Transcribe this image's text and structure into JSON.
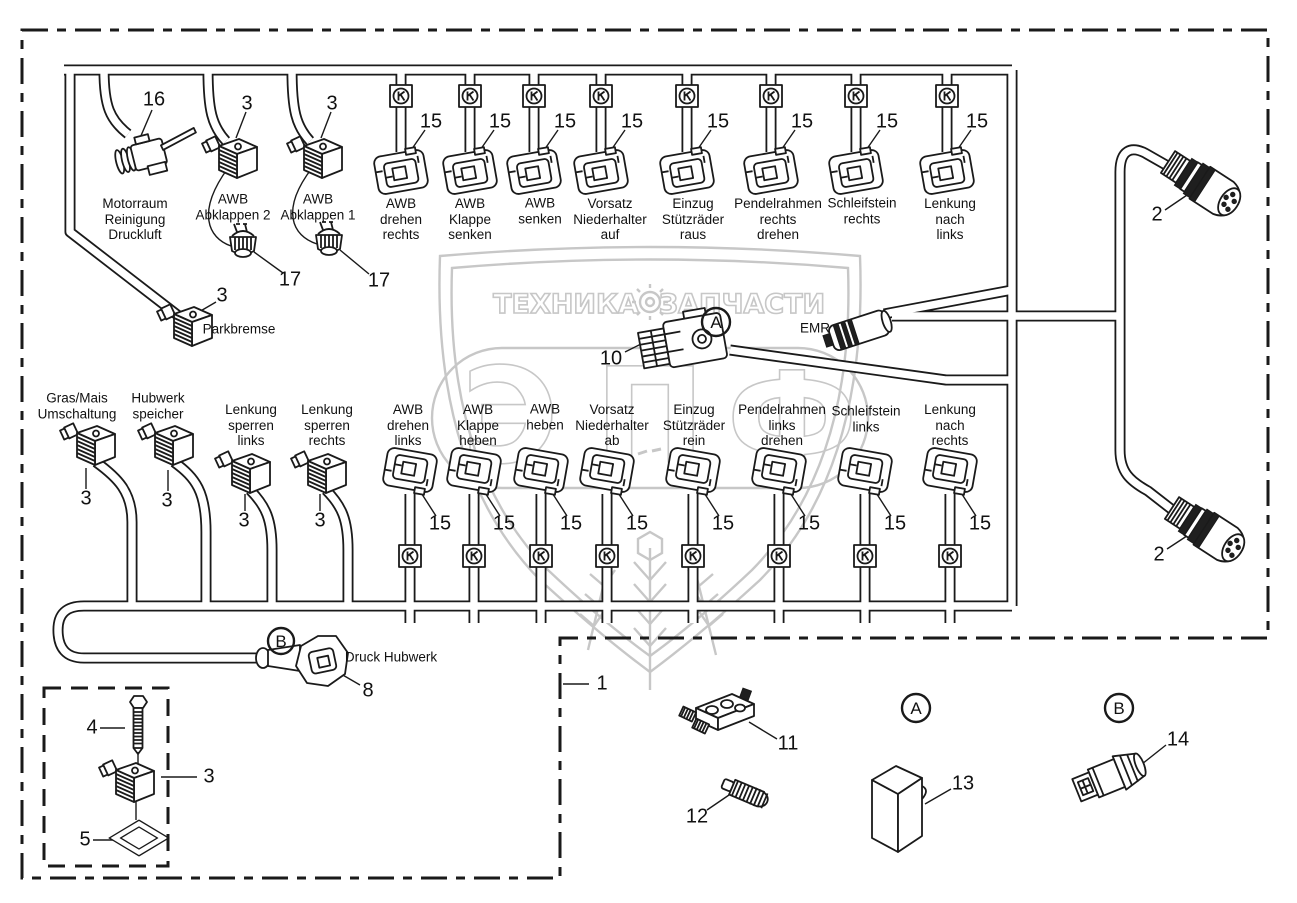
{
  "diagram": {
    "callouts": {
      "a": "A",
      "b": "B"
    },
    "rows": {
      "top": [
        {
          "label": "Motorraum\nReinigung\nDruckluft",
          "num": "16"
        },
        {
          "label": "AWB\nAbklappen 2",
          "num": "3",
          "plug_num": "17"
        },
        {
          "label": "AWB\nAbklappen 1",
          "num": "3",
          "plug_num": "17"
        },
        {
          "label": "AWB\ndrehen\nrechts",
          "num": "15"
        },
        {
          "label": "AWB\nKlappe\nsenken",
          "num": "15"
        },
        {
          "label": "AWB\nsenken",
          "num": "15"
        },
        {
          "label": "Vorsatz\nNiederhalter\nauf",
          "num": "15"
        },
        {
          "label": "Einzug\nStützräder\nraus",
          "num": "15"
        },
        {
          "label": "Pendelrahmen\nrechts\ndrehen",
          "num": "15"
        },
        {
          "label": "Schleifstein\nrechts",
          "num": "15"
        },
        {
          "label": "Lenkung\nnach\nlinks",
          "num": "15"
        }
      ],
      "bottom": [
        {
          "label": "Gras/Mais\nUmschaltung",
          "num": "3"
        },
        {
          "label": "Hubwerk\nspeicher",
          "num": "3"
        },
        {
          "label": "Lenkung\nsperren\nlinks",
          "num": "3"
        },
        {
          "label": "Lenkung\nsperren\nrechts",
          "num": "3"
        },
        {
          "label": "AWB\ndrehen\nlinks",
          "num": "15"
        },
        {
          "label": "AWB\nKlappe\nheben",
          "num": "15"
        },
        {
          "label": "AWB\nheben",
          "num": "15"
        },
        {
          "label": "Vorsatz\nNiederhalter\nab",
          "num": "15"
        },
        {
          "label": "Einzug\nStützräder\nrein",
          "num": "15"
        },
        {
          "label": "Pendelrahmen\nlinks\ndrehen",
          "num": "15"
        },
        {
          "label": "Schleifstein\nlinks",
          "num": "15"
        },
        {
          "label": "Lenkung\nnach\nrechts",
          "num": "15"
        }
      ]
    },
    "parkbremse": {
      "label": "Parkbremse",
      "num": "3"
    },
    "emr_label": "EMR",
    "main_plug_num": "10",
    "round_connector_top_num": "2",
    "round_connector_bottom_num": "2",
    "druck_hubwerk": {
      "label": "Druck Hubwerk",
      "num": "8"
    },
    "harness_num": "1",
    "inset": {
      "bolt_num": "4",
      "connector_num": "3",
      "seal_num": "5"
    },
    "parts": {
      "block_num": "11",
      "plug_num": "12",
      "box_num": "13",
      "sensor_num": "14"
    },
    "watermark": {
      "banner_left": "ТЕХНИКА",
      "banner_right": "ЗАПЧАСТИ",
      "letters": [
        "Э",
        "П",
        "Ф"
      ]
    }
  },
  "colors": {
    "line": "#1a1a1a",
    "watermark": "#c7c7c7",
    "background": "#ffffff"
  }
}
